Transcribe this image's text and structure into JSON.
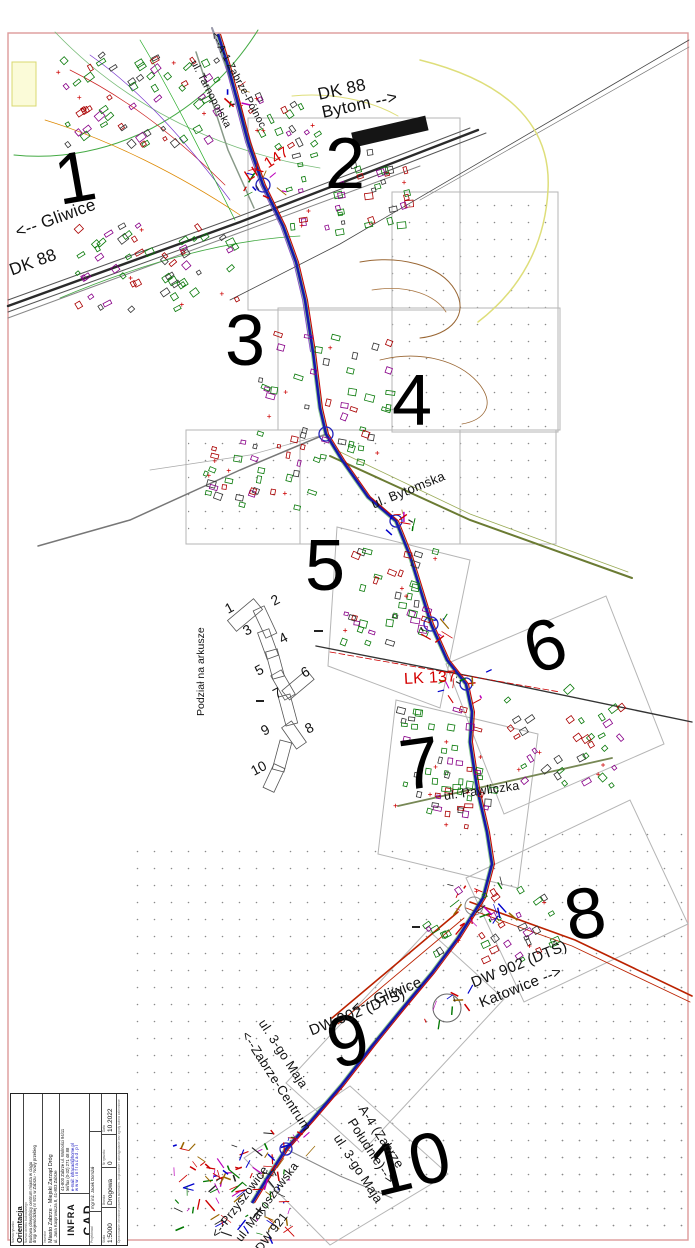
{
  "drawing": {
    "name": "Orientacja",
    "scale": "1:5000",
    "sheet_count": 10
  },
  "map_labels": [
    {
      "id": "dk88-east-1",
      "text": "DK 88"
    },
    {
      "id": "dk88-east-2",
      "text": "Bytom -->"
    },
    {
      "id": "gliwice-nw",
      "text": "<-- Gliwice"
    },
    {
      "id": "dk88-west",
      "text": "DK 88"
    },
    {
      "id": "a1-north",
      "text": "<--A-1 Zabrze-Północ"
    },
    {
      "id": "tarnopolska",
      "text": "ul. Tarnopolska"
    },
    {
      "id": "lk147",
      "text": "LK 147"
    },
    {
      "id": "bytomska",
      "text": "ul. Bytomska"
    },
    {
      "id": "lk137",
      "text": "LK 137"
    },
    {
      "id": "pawliczka",
      "text": "ul. Pawliczka"
    },
    {
      "id": "gliwice-dts",
      "text": "<-- Gliwice"
    },
    {
      "id": "dw902-west",
      "text": "DW 902 (DTŚ)"
    },
    {
      "id": "dw902-east",
      "text": "DW 902 (DTŚ)"
    },
    {
      "id": "katowice",
      "text": "Katowice -->"
    },
    {
      "id": "maja-centrum-1",
      "text": "ul. 3-go Maja"
    },
    {
      "id": "maja-centrum-2",
      "text": "<--Zabrze-Centrum"
    },
    {
      "id": "a4-line1",
      "text": "A-4 (Zabrze"
    },
    {
      "id": "a4-line2",
      "text": "Południe)-->"
    },
    {
      "id": "maja-south",
      "text": "ul. 3-go Maja"
    },
    {
      "id": "makoszowska",
      "text": "ul. Makoszowska"
    },
    {
      "id": "dw921",
      "text": "DW 921"
    },
    {
      "id": "przyszowice",
      "text": "<--Przyszowice"
    }
  ],
  "sheet_numbers": [
    "1",
    "2",
    "3",
    "4",
    "5",
    "6",
    "7",
    "8",
    "9",
    "10"
  ],
  "sheet_index": {
    "title": "Podział na arkusze",
    "numbers": [
      "1",
      "2",
      "3",
      "4",
      "5",
      "6",
      "7",
      "8",
      "9",
      "10"
    ]
  },
  "title_block": {
    "drawing_label": "Nazwa rysunku",
    "drawing_name": "Orientacja",
    "project_label": "Nazwa obiektu budowlanego",
    "project_line1": "Budowa obwodnicy centrum miasta w ciągu",
    "project_line2": "drogi wojewódzkiej nr 921 w Zabrzu - Nowy przebieg",
    "investor_label": "Inwestor",
    "investor_line1": "Miasto Zabrze - Miejski Zarząd Dróg",
    "investor_line2": "ul. Jana Kasprowicza 8, 41-803 Zabrze",
    "company_name_1": "INFRA",
    "company_name_2": "CAD",
    "company_owner": "Jacek Domżał",
    "contact_line1": "41-800 Zabrze  ul. Wolności 94/11",
    "contact_line2": "tel/fax (0-32) 271 48 88",
    "contact_email": "e-mail: infracad@home.pl",
    "contact_www": "w w w . i n f r a c a d . p l",
    "role_label": "Projektował",
    "designer": "mgr inż. Jacek Domżał",
    "scale_label": "Skala",
    "scale": "1:5000",
    "branch_label": "Branża",
    "branch": "Drogowa",
    "number_label": "Nr rysunku",
    "number": "0",
    "date_label": "Data",
    "date": "10.2022",
    "footer_note": "Opracowanie chronione prawem autorskim - kopiowanie i udostępnianie bez zgody autora zabronione"
  }
}
